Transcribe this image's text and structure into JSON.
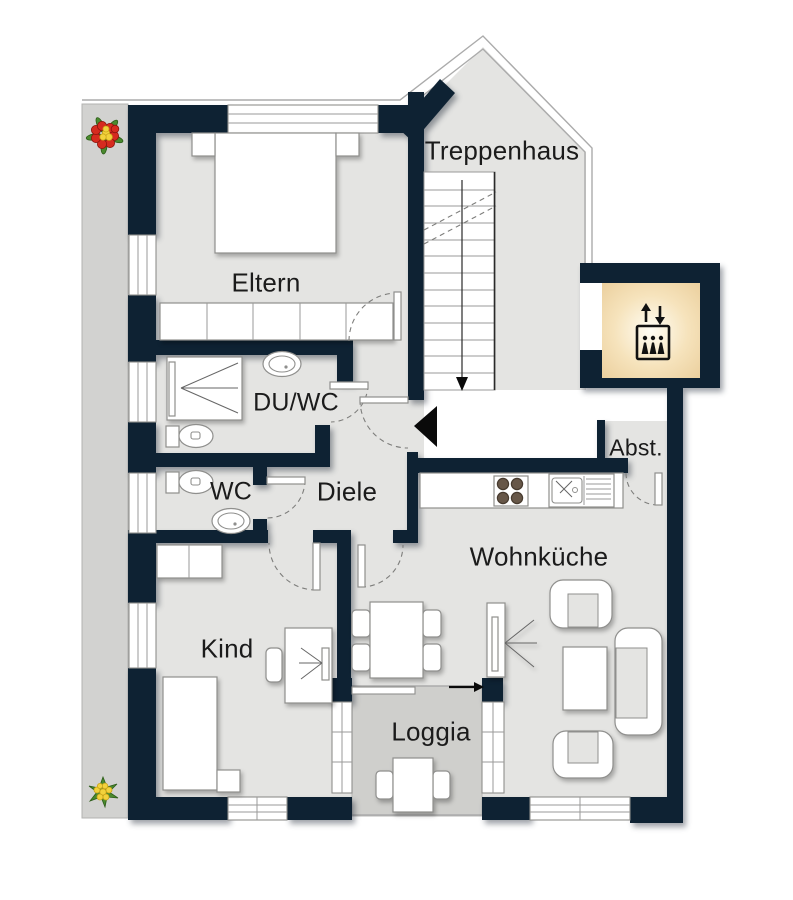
{
  "title": "Apartment floor plan",
  "rooms": {
    "treppenhaus": {
      "label": "Treppenhaus"
    },
    "eltern": {
      "label": "Eltern"
    },
    "du_wc": {
      "label": "DU/WC"
    },
    "wc": {
      "label": "WC"
    },
    "diele": {
      "label": "Diele"
    },
    "abstellraum": {
      "label": "Abst."
    },
    "wohnkueche": {
      "label": "Wohnküche"
    },
    "kind": {
      "label": "Kind"
    },
    "loggia": {
      "label": "Loggia"
    }
  },
  "icons": {
    "elevator": "elevator-icon",
    "flower_top": "flower-icon",
    "flower_bottom": "flower-icon",
    "entrance_marker": "entrance-triangle-icon",
    "stairs_direction": "stairs-down-arrow-icon",
    "loggia_entry": "loggia-entry-arrow-icon"
  },
  "colors": {
    "wall": "#0e2233",
    "room": "#e4e4e2",
    "loggia": "#cfcfcc",
    "strip": "#d2d2d0",
    "warm-center": "#fffdf4",
    "warm-mid": "#f6e3bc",
    "warm-edge": "#ecd1a0",
    "flower-red": "#d62b1f",
    "flower-yellow": "#f2d23c",
    "leaf-green": "#4a8a2e"
  }
}
